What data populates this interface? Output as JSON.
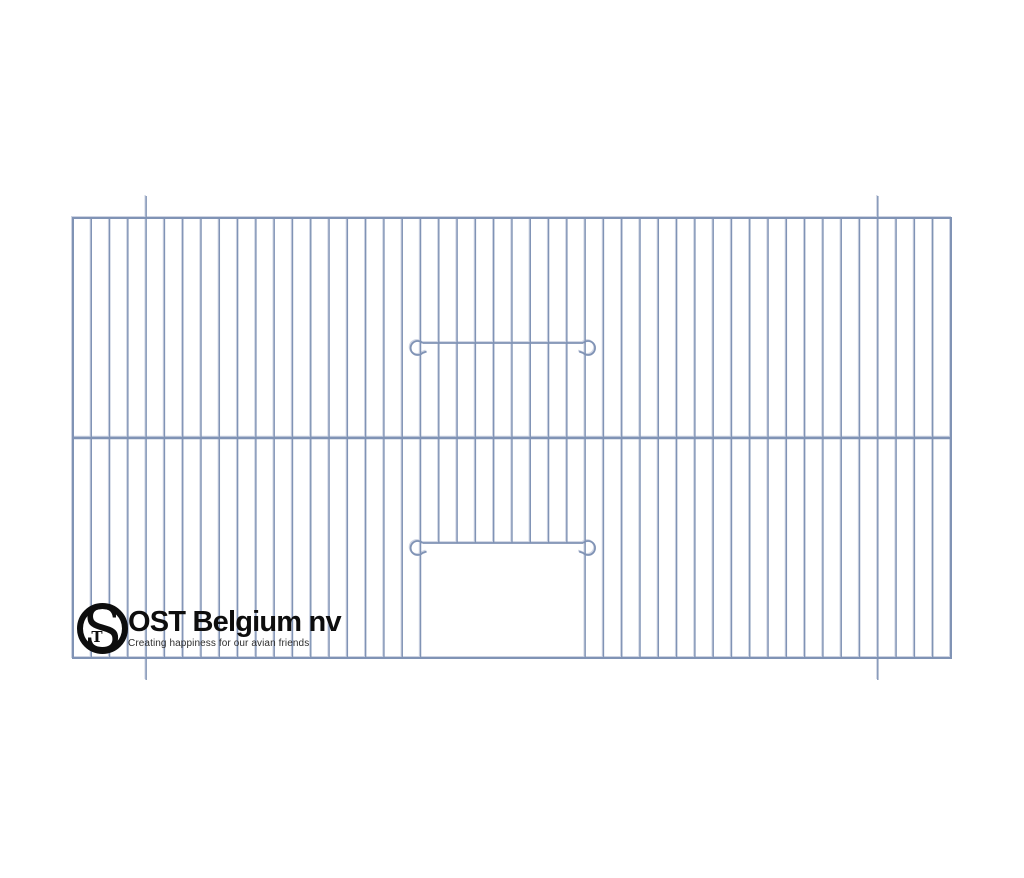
{
  "meta": {
    "width": 1024,
    "height": 878,
    "background": "#ffffff"
  },
  "drawing": {
    "name": "bird-cage-front-panel",
    "wire_color": "#8093b5",
    "wire_highlight": "#d6dbe6",
    "frame": {
      "left": 73,
      "top": 218,
      "right": 951,
      "bottom": 658
    },
    "bars": {
      "count": 49,
      "spacing": 18.2917
    },
    "middle_rail_y": 438,
    "door": {
      "left_bar_index": 19,
      "right_bar_index": 28,
      "top_rod_y": 343,
      "bottom_rod_y": 543,
      "hook_radius": 7,
      "hook_gap": 10
    },
    "hanger_ticks": {
      "bar_indices": [
        4,
        44
      ],
      "length": 22
    },
    "stroke": {
      "frame": 2,
      "bar": 1.4,
      "rail": 2.4,
      "rod": 1.8
    }
  },
  "logo": {
    "monogram": {
      "letter_s": "S",
      "letter_t": "T",
      "color": "#0d0d0d"
    },
    "title": "OST Belgium nv",
    "tagline": "Creating happiness for our avian friends",
    "title_color": "#0d0d0d",
    "tagline_color": "#2e2e2e"
  }
}
